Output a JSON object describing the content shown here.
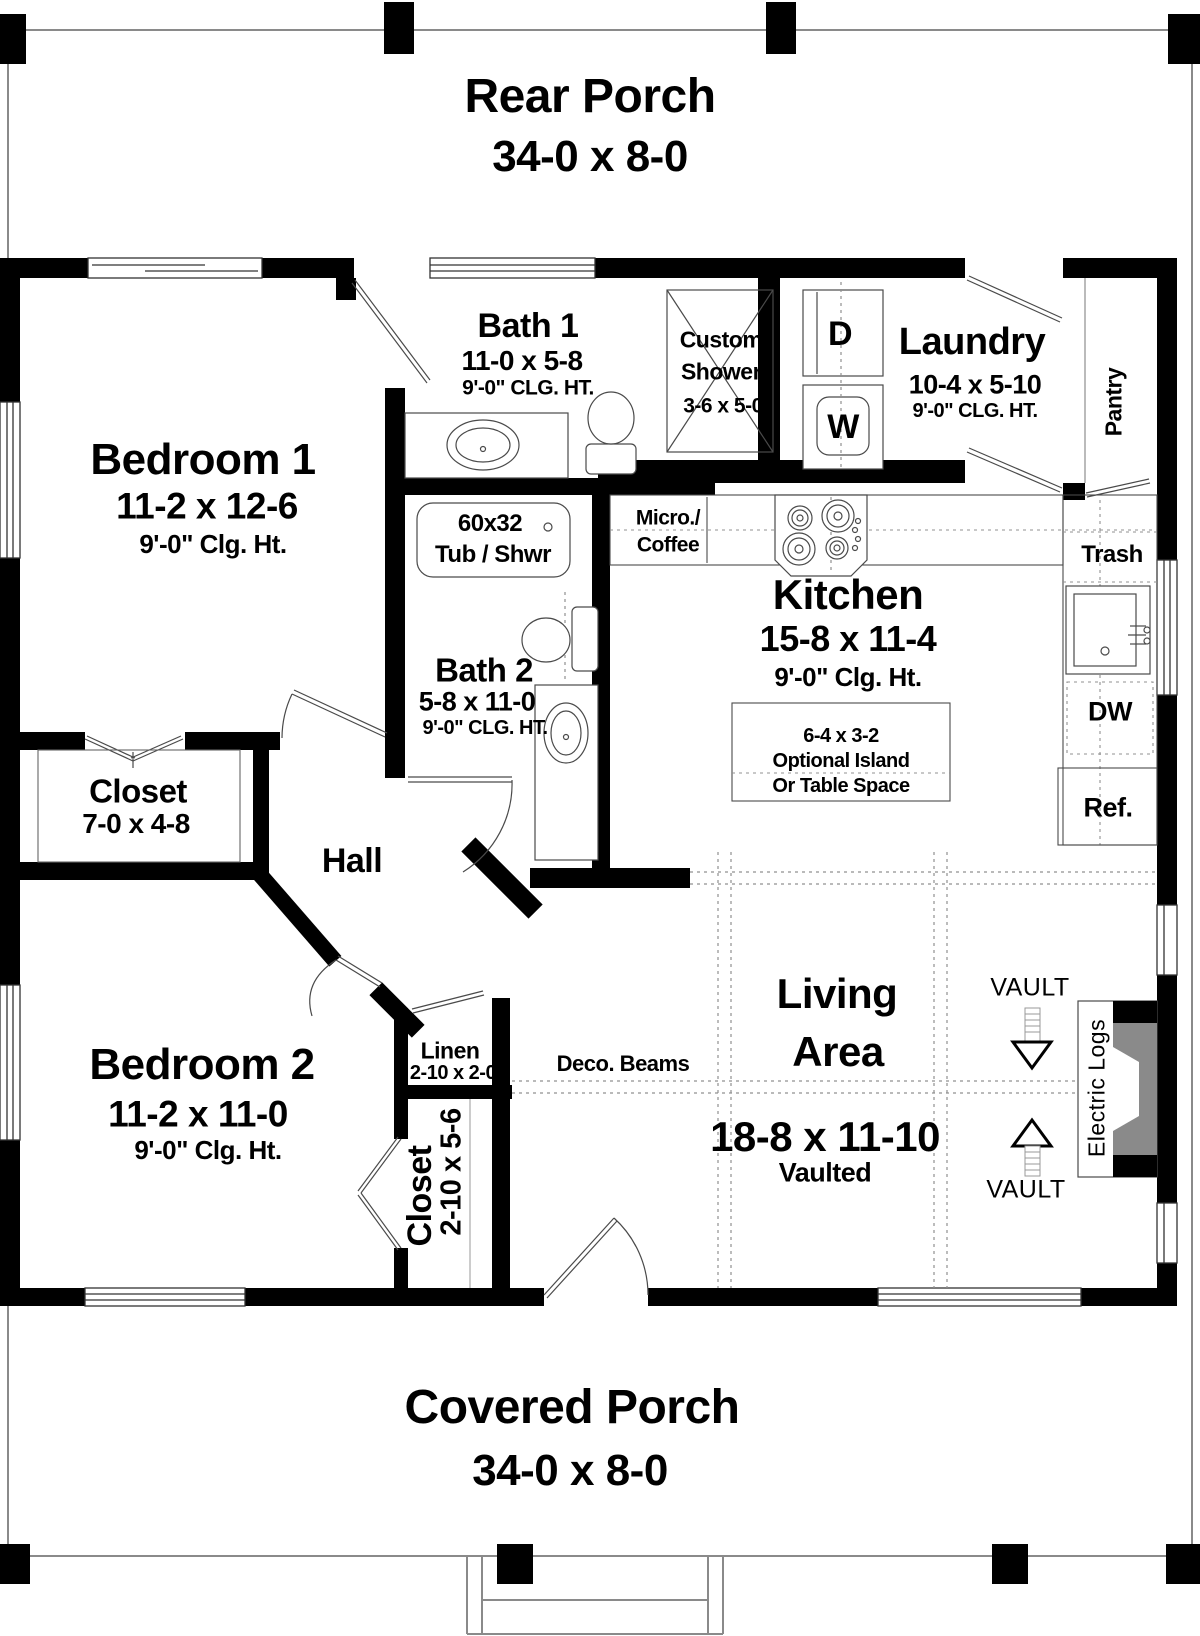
{
  "rooms": {
    "rear_porch": {
      "name": "Rear Porch",
      "dims": "34-0 x 8-0"
    },
    "covered_porch": {
      "name": "Covered Porch",
      "dims": "34-0 x 8-0"
    },
    "bedroom1": {
      "name": "Bedroom 1",
      "dims": "11-2 x 12-6",
      "ceiling": "9'-0\" Clg. Ht."
    },
    "bedroom2": {
      "name": "Bedroom 2",
      "dims": "11-2 x 11-0",
      "ceiling": "9'-0\" Clg. Ht."
    },
    "bath1": {
      "name": "Bath 1",
      "dims": "11-0 x 5-8",
      "ceiling": "9'-0\" CLG. HT."
    },
    "bath2": {
      "name": "Bath 2",
      "dims": "5-8 x 11-0",
      "ceiling": "9'-0\" CLG. HT."
    },
    "kitchen": {
      "name": "Kitchen",
      "dims": "15-8 x 11-4",
      "ceiling": "9'-0\" Clg. Ht."
    },
    "laundry": {
      "name": "Laundry",
      "dims": "10-4 x 5-10",
      "ceiling": "9'-0\" CLG. HT."
    },
    "living": {
      "name_line1": "Living",
      "name_line2": "Area",
      "dims": "18-8 x 11-10",
      "note": "Vaulted"
    },
    "hall": {
      "name": "Hall"
    },
    "pantry": {
      "name": "Pantry"
    },
    "closet1": {
      "name": "Closet",
      "dims": "7-0 x 4-8"
    },
    "closet2": {
      "name": "Closet",
      "dims": "2-10 x 5-6"
    },
    "linen": {
      "name": "Linen",
      "dims": "2-10 x 2-0"
    }
  },
  "fixtures": {
    "custom_shower": {
      "line1": "Custom",
      "line2": "Shower",
      "dims": "3-6 x 5-0"
    },
    "tub": {
      "line1": "60x32",
      "line2": "Tub / Shwr"
    },
    "micro": {
      "line1": "Micro./",
      "line2": "Coffee"
    },
    "island": {
      "dims": "6-4 x 3-2",
      "line2": "Optional Island",
      "line3": "Or Table Space"
    },
    "trash": "Trash",
    "dishwasher": "DW",
    "refrigerator": "Ref.",
    "fireplace": "Electric Logs",
    "washer": "W",
    "dryer": "D"
  },
  "annotations": {
    "deco_beams": "Deco. Beams",
    "vault": "VAULT"
  },
  "colors": {
    "wall": "#000000",
    "line": "#4a4a4a",
    "chimney": "#8a8a8a",
    "background": "#ffffff"
  }
}
